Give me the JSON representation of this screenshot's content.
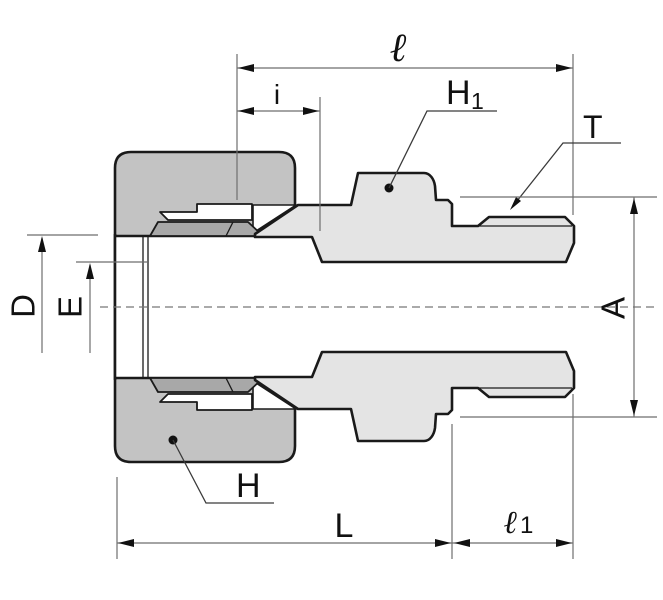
{
  "figure": {
    "type": "technical-drawing",
    "subject": "compression tube fitting male connector cross-section",
    "background": "#ffffff",
    "colors": {
      "nut_fill": "#c3c3c3",
      "ferrule_fill": "#a8a8a8",
      "body_fill": "#e4e4e4",
      "bore_fill": "#ffffff",
      "outline": "#1a1a1a",
      "dimension_line": "#6e6e6e",
      "centerline": "#777777",
      "label_color": "#111111"
    },
    "labels": {
      "ell": "ℓ",
      "i": "i",
      "h1": {
        "main": "H",
        "sub": "1"
      },
      "t": "T",
      "d": "D",
      "e": "E",
      "a": "A",
      "h": "H",
      "l": "L",
      "l1": {
        "main": "ℓ",
        "sub": "1"
      }
    }
  }
}
